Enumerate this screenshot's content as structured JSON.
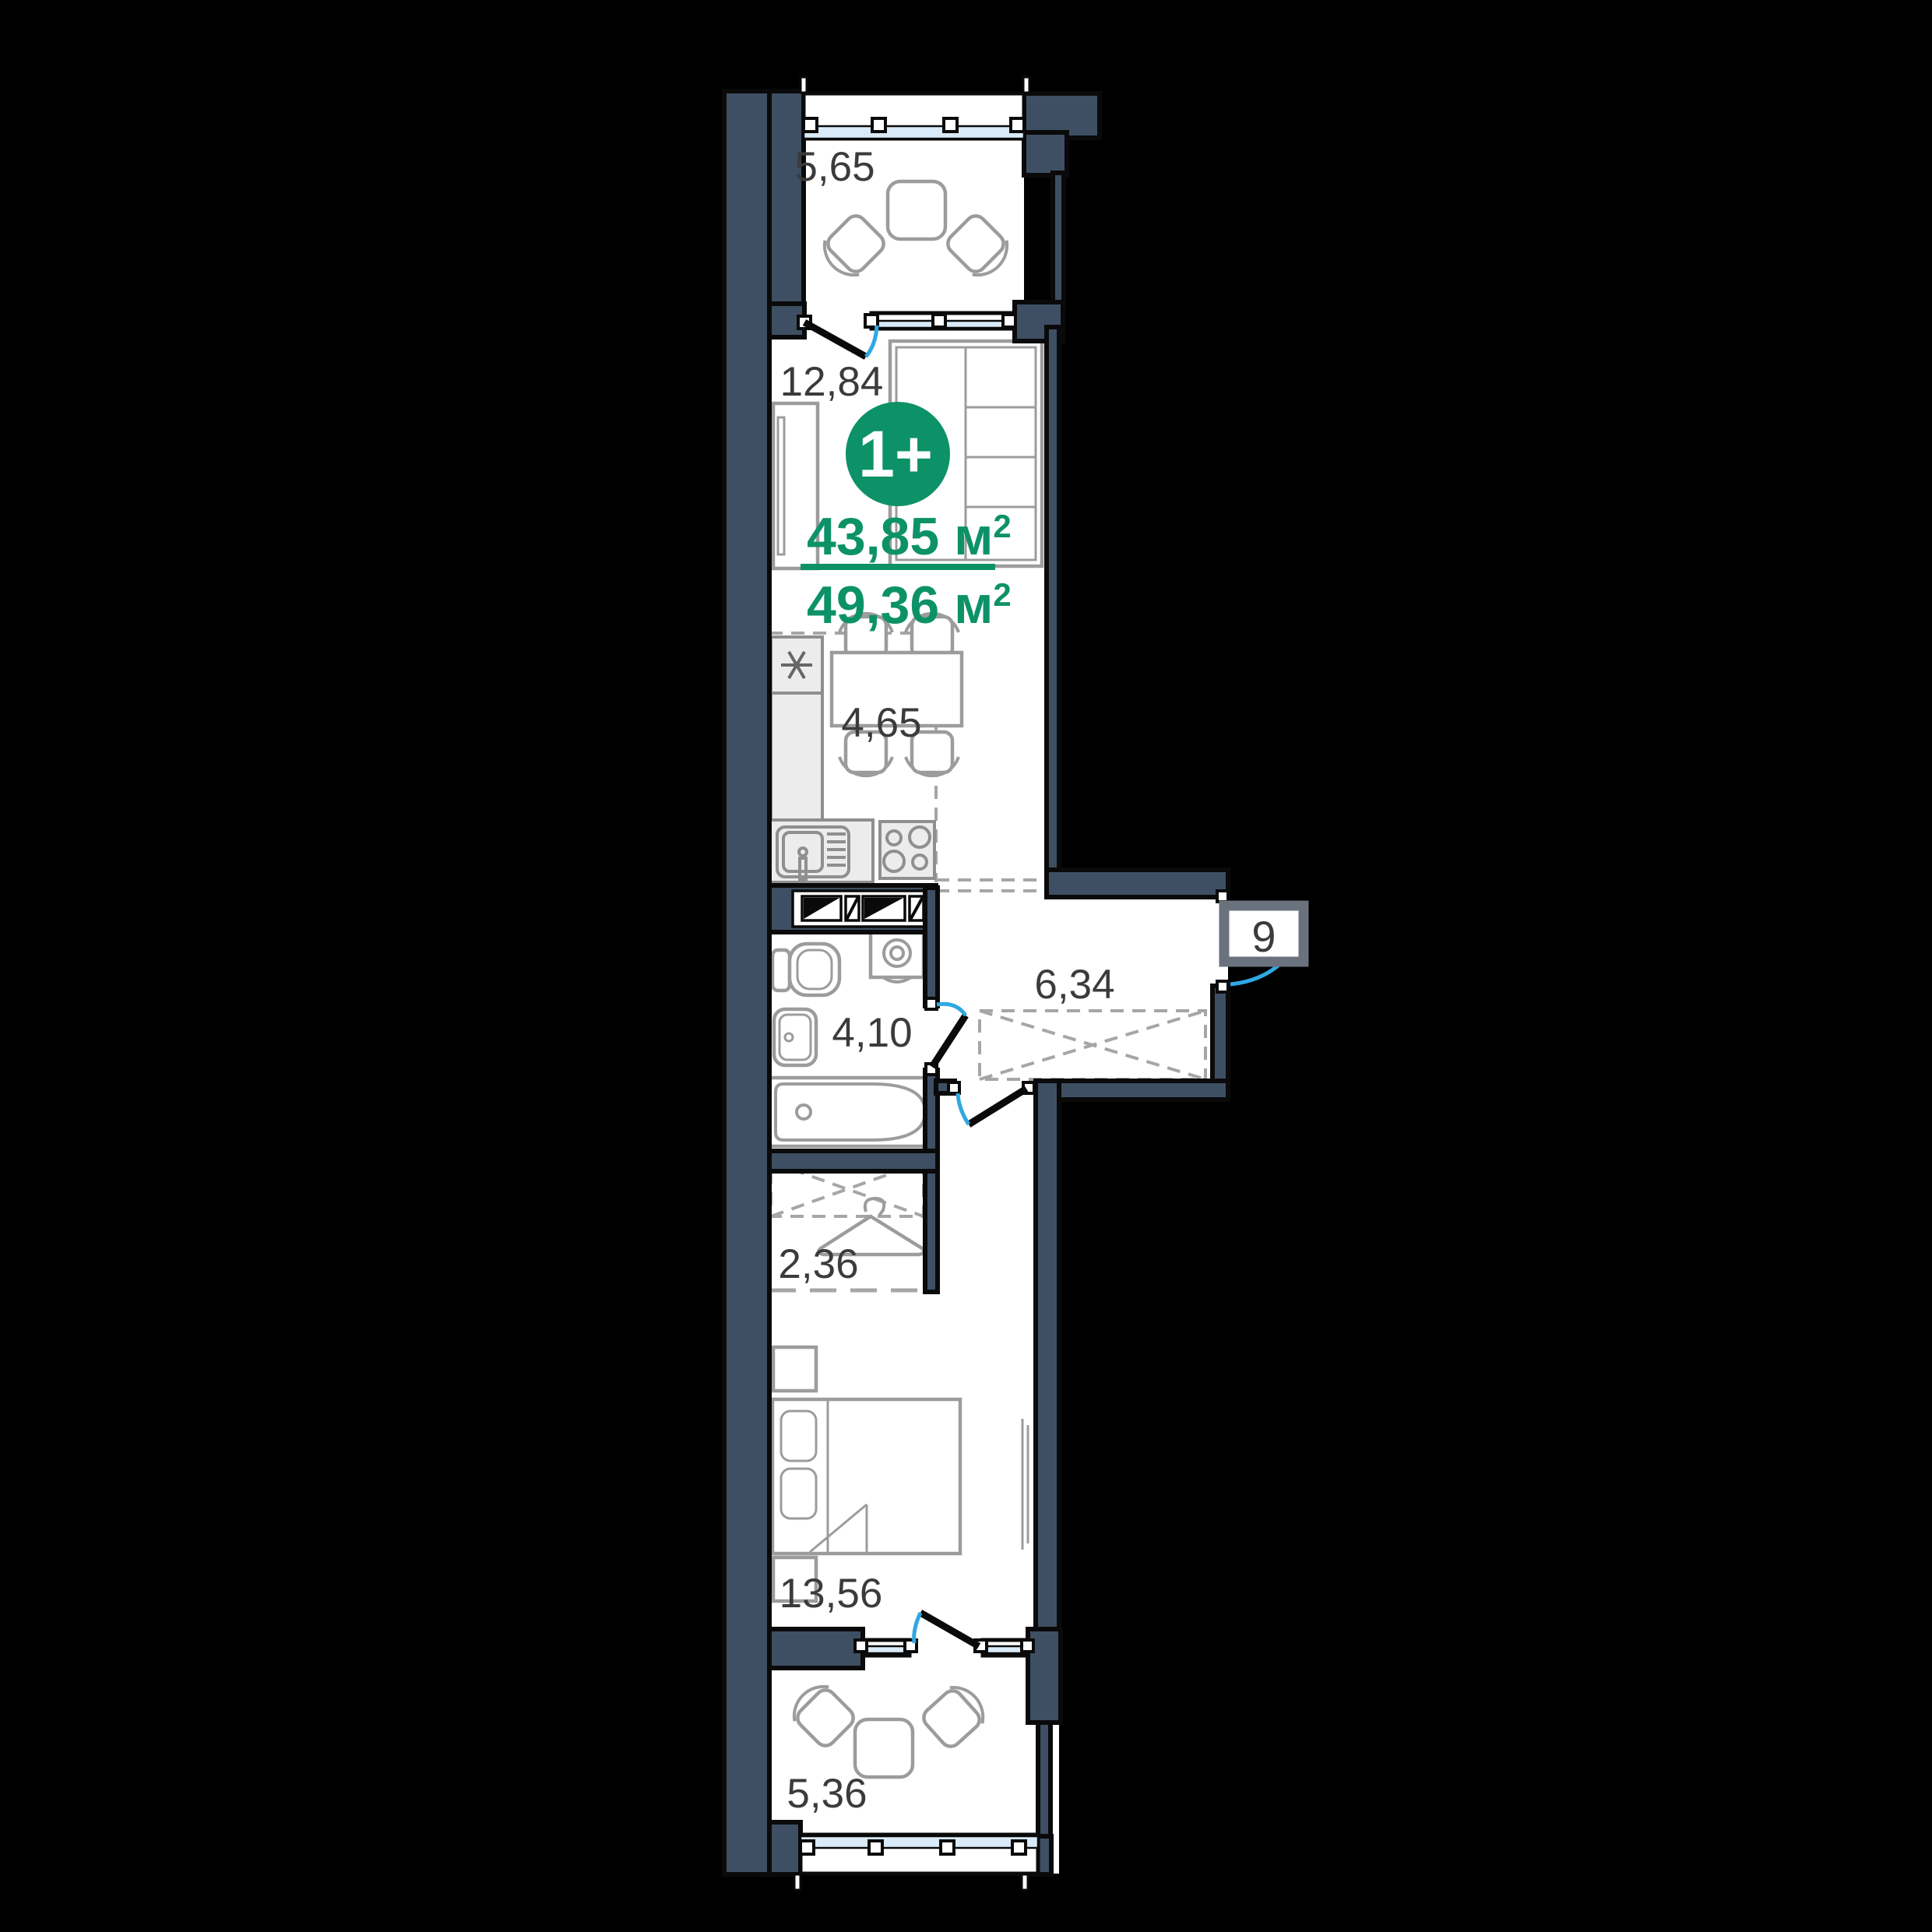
{
  "colors": {
    "bg": "#000000",
    "wall": "#3E4F63",
    "outline": "#0A0A0A",
    "accent": "#0D9268",
    "glazing": "#D9EAF8",
    "door_arc": "#2FA8E1",
    "label": "#3B3B3B",
    "furniture": "#9C9C9C",
    "appliance": "#ECECEC",
    "badge_border": "#6A737D"
  },
  "unit": {
    "type_badge": "1+",
    "area_living": "43,85",
    "area_total": "49,36",
    "area_unit": " м",
    "area_sup": "2",
    "number": "9"
  },
  "rooms": {
    "balcony_top": "5,65",
    "living": "12,84",
    "kitchen": "4,65",
    "hall": "6,34",
    "bathroom": "4,10",
    "wardrobe": "2,36",
    "bedroom": "13,56",
    "balcony_bottom": "5,36"
  }
}
